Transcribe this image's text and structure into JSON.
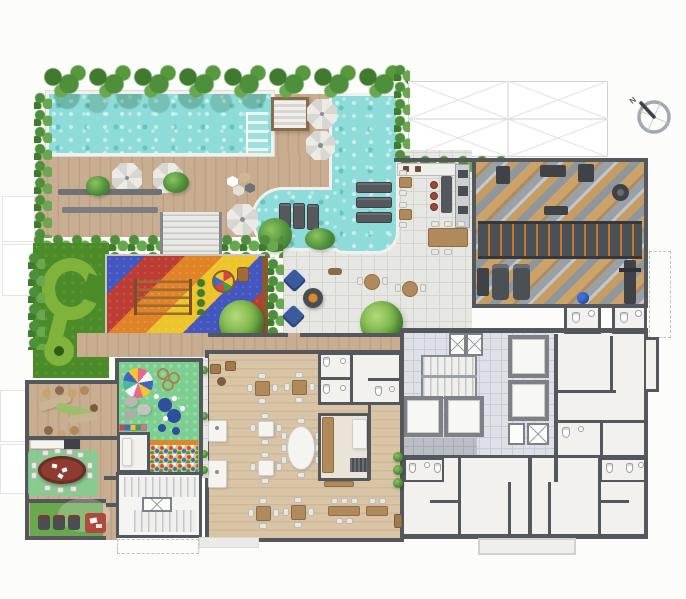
{
  "compass": {
    "label": "N"
  },
  "palette": {
    "page": "#fcfcfb",
    "wall": "#54585c",
    "deck1": "#c9ad90",
    "deck2": "#bda184",
    "party1": "#d9c4a6",
    "party2": "#cfb899",
    "water": "#8edcda",
    "coping": "#f0f1ee",
    "plaza": "#e6e6e2",
    "plaza-line": "#d5d5d0",
    "core-tile": "#dde0e6",
    "core-line": "#c8ccd4",
    "dark-tile": "#b9bec6",
    "room": "#f2f1ed",
    "lawn": "#4c8c28",
    "putt": "#7fb33b",
    "kids-green": "#7ccf90",
    "cinema-green": "#6aa84f",
    "hedge-a": "#4e8f3c",
    "hedge-b": "#6aa84f",
    "hedge-c": "#3f7a2e",
    "gym-tan": "#cda269",
    "gym-gray": "#9aa1a6",
    "rig": "#4b5054",
    "rig-orange": "#c8762f",
    "play-blue": "#4456c0",
    "play-red": "#bd3d34",
    "play-orange": "#e08226",
    "play-yellow": "#eec42b",
    "pouf-blue": "#3b5aa0",
    "poker-red": "#8e3b32",
    "rug-red": "#b04a3c",
    "wood-furn": "#b08a5a",
    "chair-light": "#e9e7e1",
    "equip": "#3f4347",
    "ball-blue": "#3a6fd8",
    "umb-a": "#eceae5",
    "umb-b": "#d8d6d0"
  },
  "areas": [
    {
      "name": "lap-pool"
    },
    {
      "name": "leisure-pool"
    },
    {
      "name": "pool-steps"
    },
    {
      "name": "sun-deck"
    },
    {
      "name": "sun-cabana"
    },
    {
      "name": "pergola"
    },
    {
      "name": "fitness-gym"
    },
    {
      "name": "gym-restrooms"
    },
    {
      "name": "pool-bar"
    },
    {
      "name": "outdoor-dining"
    },
    {
      "name": "fire-pit-lounge"
    },
    {
      "name": "playground"
    },
    {
      "name": "mini-golf-green"
    },
    {
      "name": "kids-playroom"
    },
    {
      "name": "ball-pit"
    },
    {
      "name": "lounge-terrace"
    },
    {
      "name": "games-room"
    },
    {
      "name": "cinema-room"
    },
    {
      "name": "party-room"
    },
    {
      "name": "gourmet-kitchen"
    },
    {
      "name": "party-restrooms"
    },
    {
      "name": "stair-core"
    },
    {
      "name": "elevator-core"
    },
    {
      "name": "apartment-units"
    },
    {
      "name": "compass-rose"
    }
  ]
}
